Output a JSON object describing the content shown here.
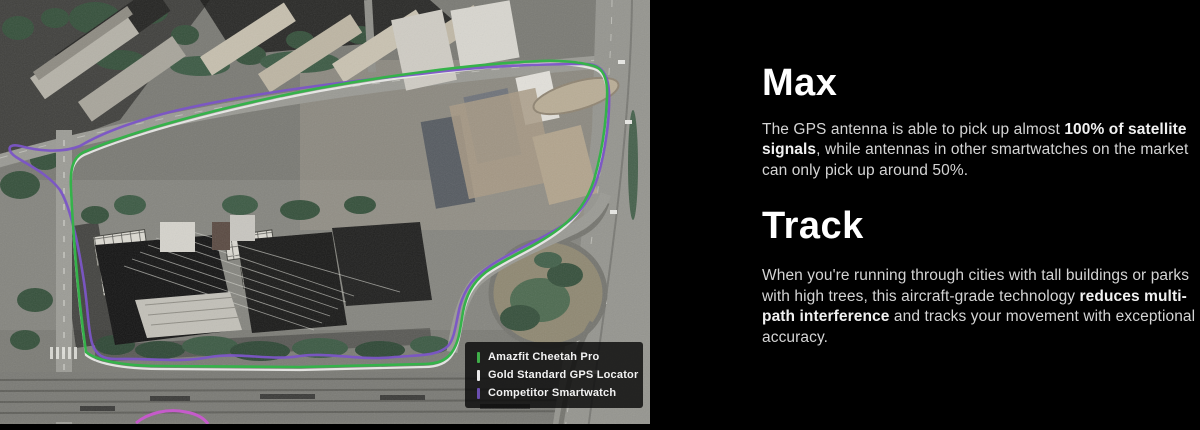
{
  "map": {
    "tracks": {
      "amazfit": "#35b24a",
      "gold": "#e8e8e6",
      "competitor": "#7b55c6",
      "competitor_stray": "#c55bca"
    },
    "legend": {
      "items": [
        {
          "label": "Amazfit Cheetah Pro",
          "color": "#3fae49"
        },
        {
          "label": "Gold Standard GPS Locator",
          "color": "#e9e9e9"
        },
        {
          "label": "Competitor Smartwatch",
          "color": "#6b4fb0"
        }
      ]
    }
  },
  "content": {
    "sections": [
      {
        "heading": "Max",
        "paragraph": [
          {
            "text": "The GPS antenna is able to pick up almost ",
            "bold": false
          },
          {
            "text": "100% of satellite signals",
            "bold": true
          },
          {
            "text": ", while antennas in other smartwatches on the market can only pick up around 50%.",
            "bold": false
          }
        ]
      },
      {
        "heading": "Track",
        "paragraph": [
          {
            "text": "When you're running through cities with tall buildings or parks with high trees, this aircraft-grade technology ",
            "bold": false
          },
          {
            "text": "reduces multi-path interference",
            "bold": true
          },
          {
            "text": " and tracks your movement with exceptional accuracy.",
            "bold": false
          }
        ]
      }
    ]
  }
}
